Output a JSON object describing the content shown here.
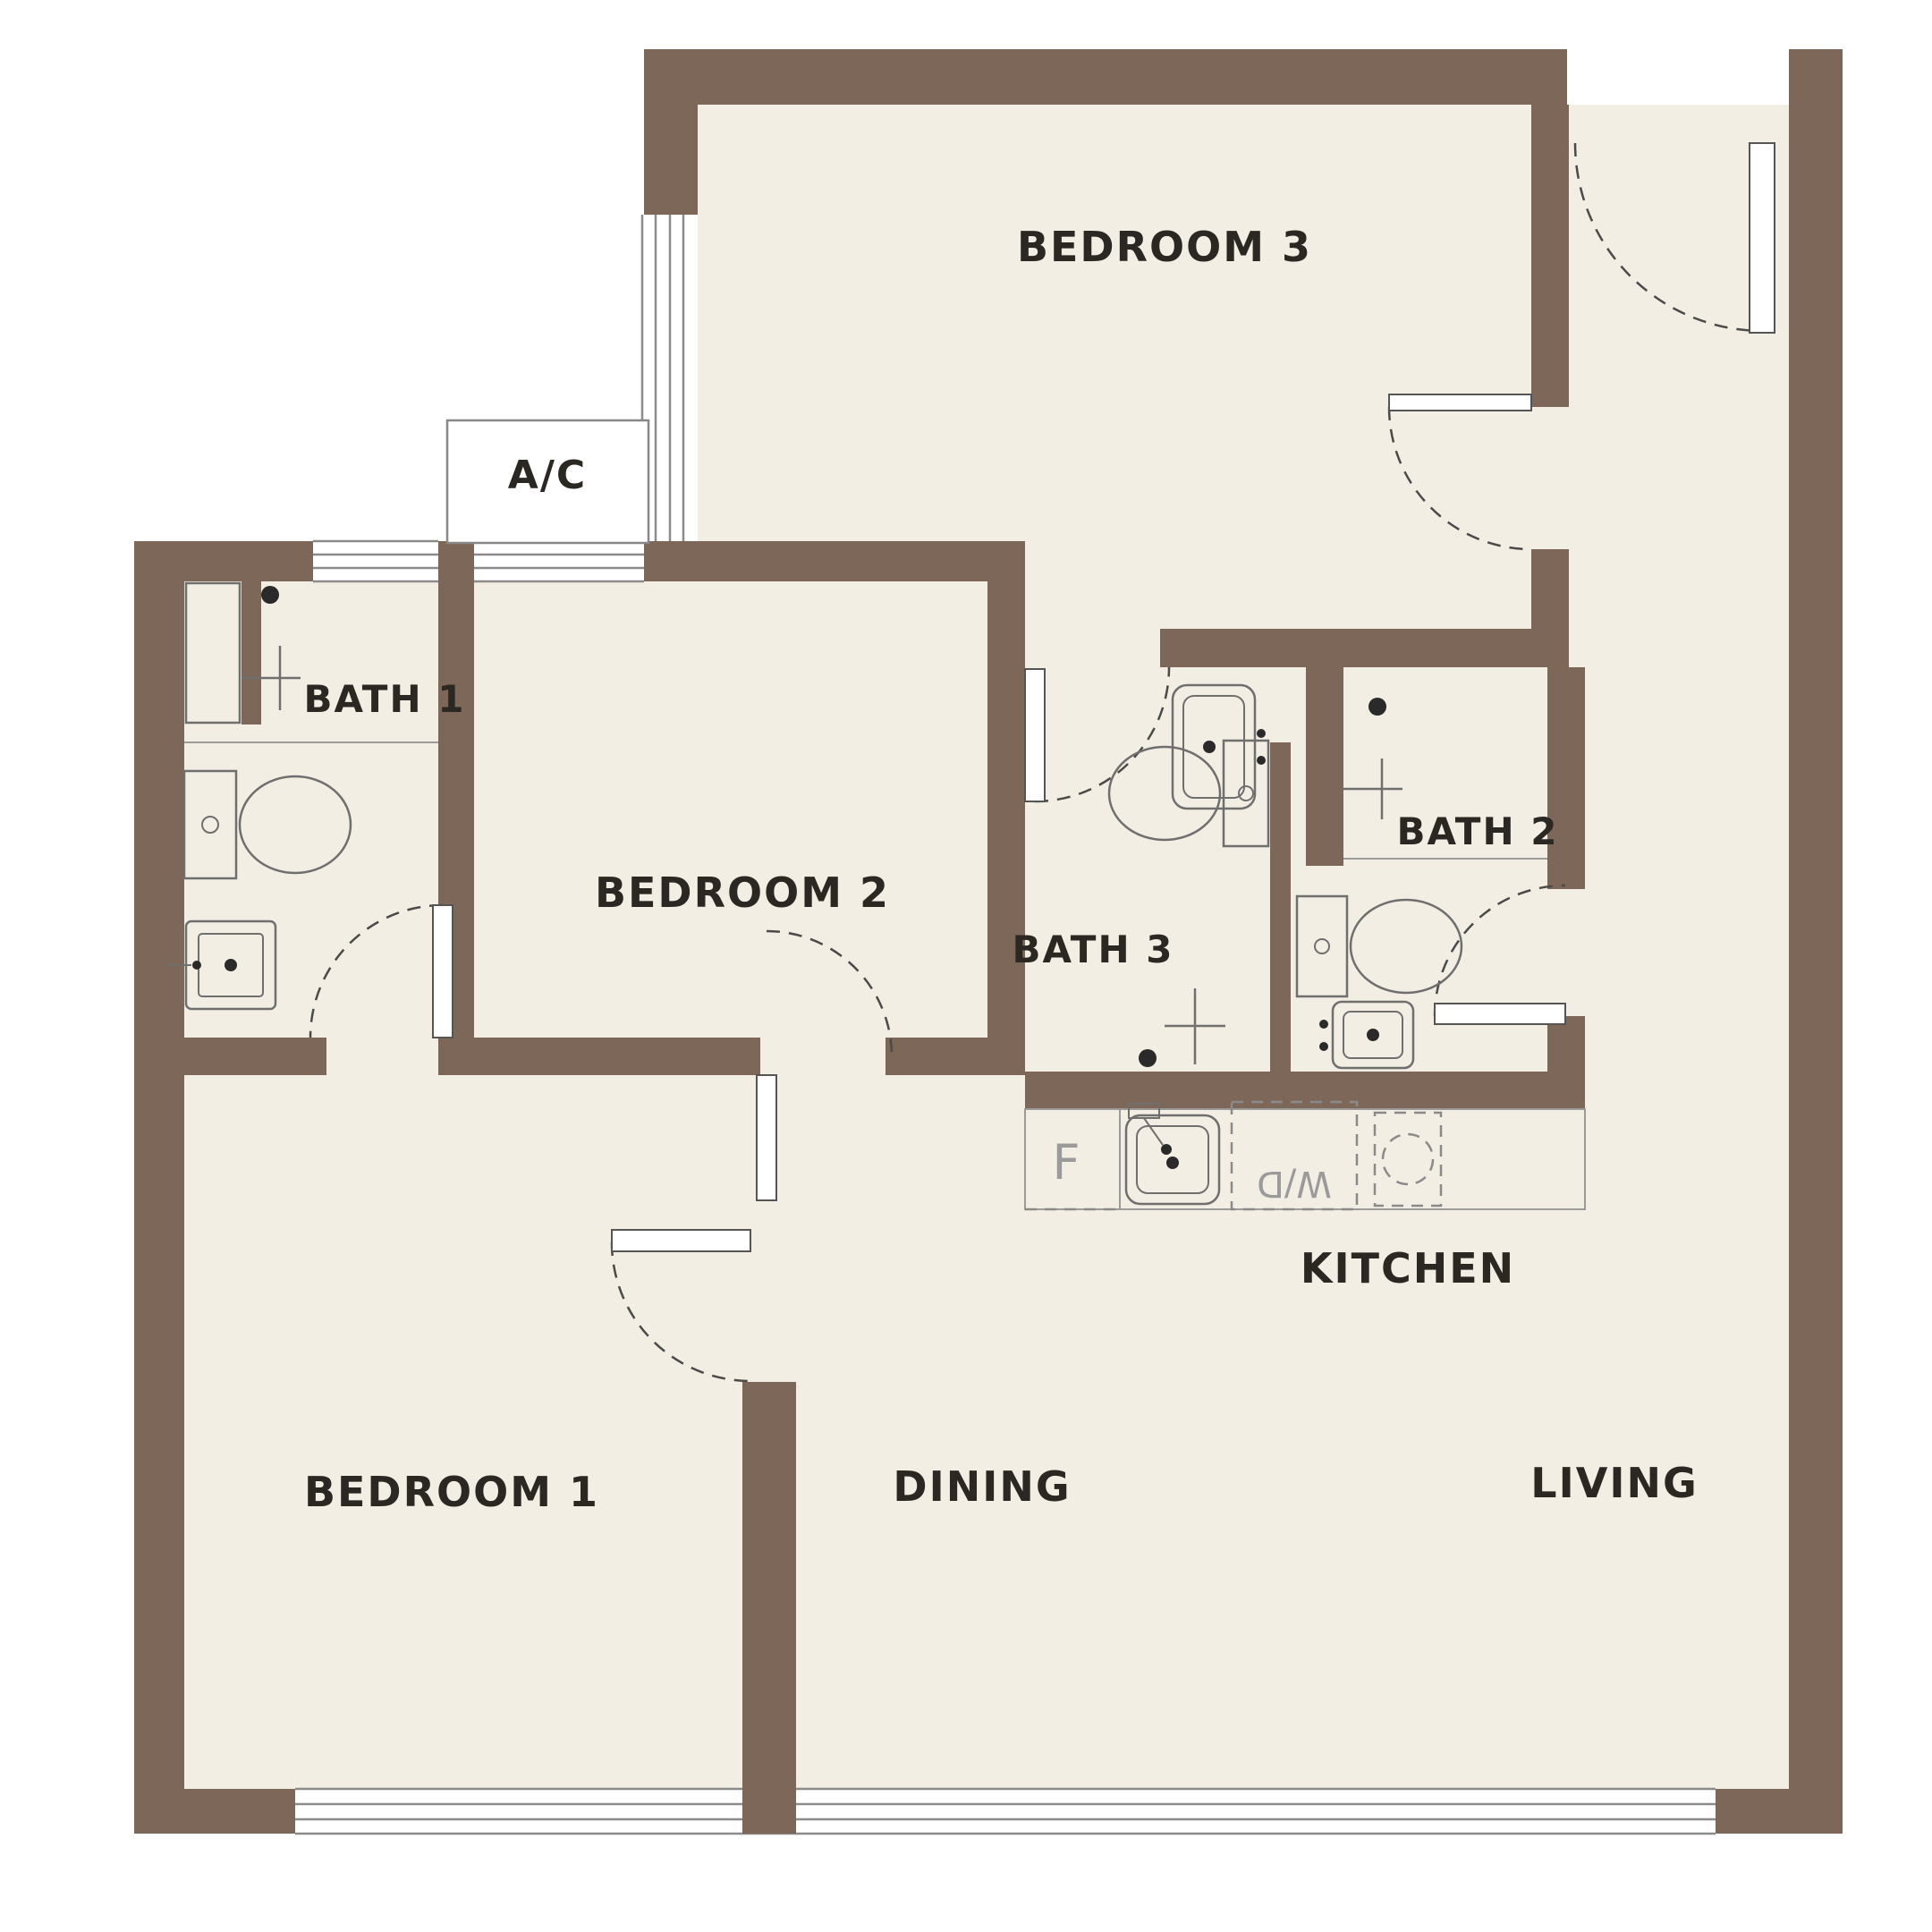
{
  "colors": {
    "wall": "#7c6759",
    "floor": "#f2eee3",
    "background": "#ffffff",
    "label_text": "#2b2723",
    "appliance_text": "#9a9a9a",
    "fixture_line": "#6f6f6f",
    "window_line": "#8b8b8b",
    "door_swing_line": "#4a4a4a"
  },
  "rooms": {
    "bedroom1": {
      "label": "BEDROOM 1"
    },
    "bedroom2": {
      "label": "BEDROOM 2"
    },
    "bedroom3": {
      "label": "BEDROOM 3"
    },
    "bath1": {
      "label": "BATH 1",
      "fixtures": [
        "shower",
        "toilet",
        "sink"
      ]
    },
    "bath2": {
      "label": "BATH 2",
      "fixtures": [
        "shower",
        "toilet",
        "sink"
      ]
    },
    "bath3": {
      "label": "BATH 3",
      "fixtures": [
        "sink",
        "toilet",
        "shower"
      ]
    },
    "kitchen": {
      "label": "KITCHEN",
      "fridge_label": "F",
      "washer_dryer_label": "W/D",
      "appliances": [
        "fridge",
        "kitchen-sink",
        "washer-dryer",
        "stove"
      ]
    },
    "dining": {
      "label": "DINING"
    },
    "living": {
      "label": "LIVING"
    },
    "ac_ledge": {
      "label": "A/C"
    }
  }
}
